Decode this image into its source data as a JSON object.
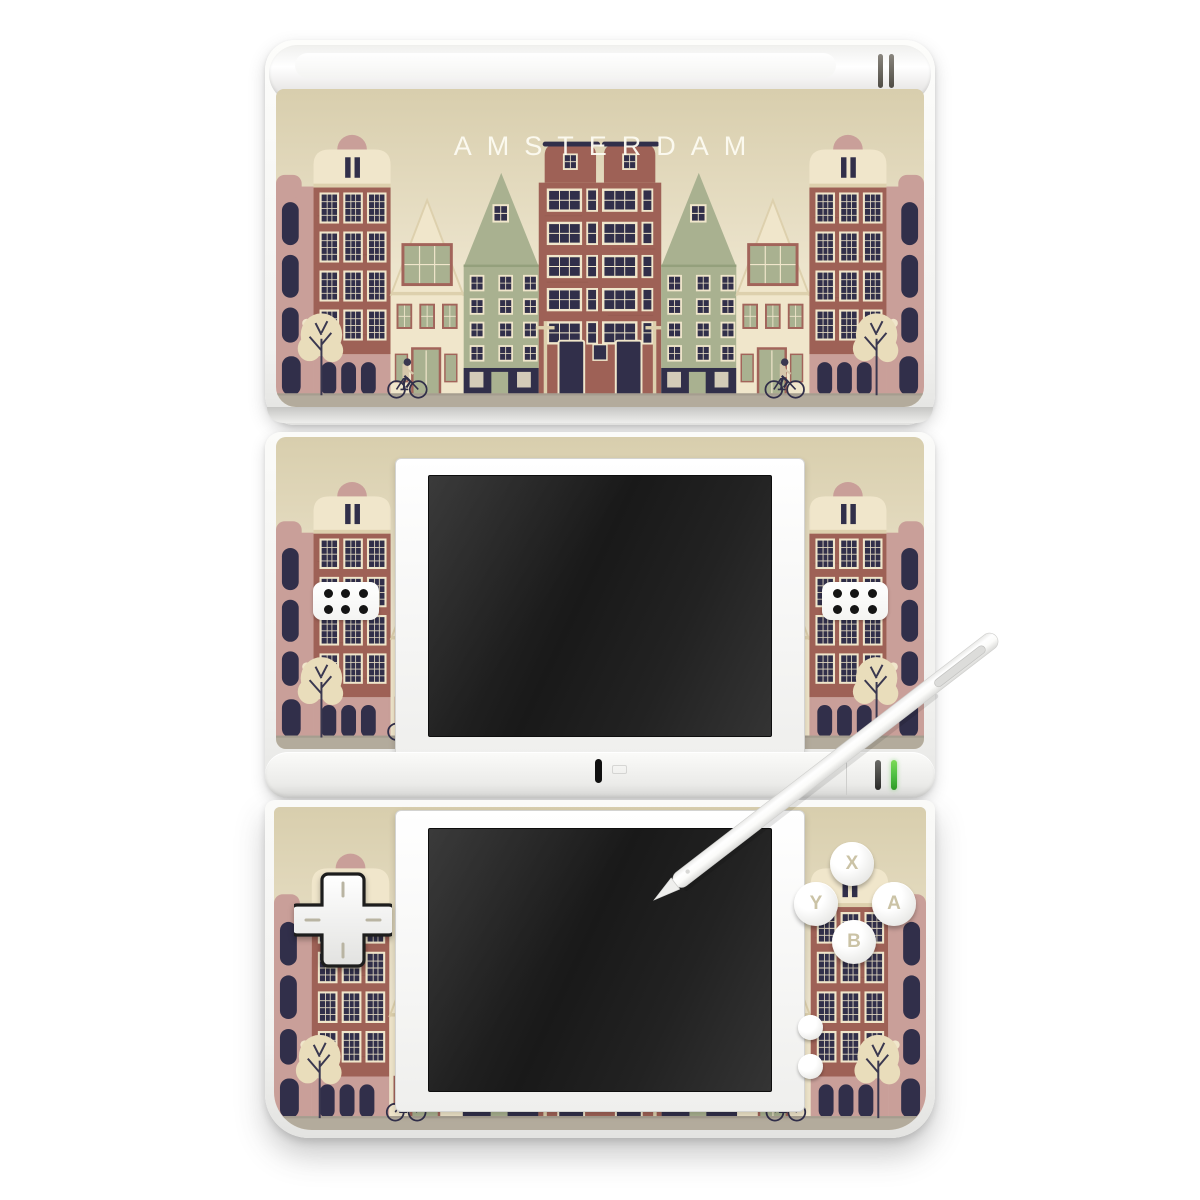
{
  "skin": {
    "title": "AMSTERDAM",
    "palette": {
      "sky_top": "#d8cead",
      "sky_bottom": "#f2ead5",
      "cream": "#f0e6cb",
      "cream_dark": "#ddd0ad",
      "brick": "#9e6156",
      "brick_dark": "#7e4c43",
      "brick_trim": "#a2645a",
      "pink": "#c99f99",
      "pink_light": "#d6b3ab",
      "sage": "#a9b190",
      "sage_dark": "#94a07c",
      "navy": "#312f4a",
      "street": "#b3ab9c",
      "tree": "#e9ddbb",
      "branch": "#3a3850",
      "tan": "#d6c7ab",
      "title_color": "#fdfbf2",
      "led_green": "#4fbf44",
      "screen_dark": "#1d1d1d"
    }
  },
  "controls": {
    "action_buttons": [
      {
        "label": "X"
      },
      {
        "label": "Y"
      },
      {
        "label": "A"
      },
      {
        "label": "B"
      }
    ]
  }
}
